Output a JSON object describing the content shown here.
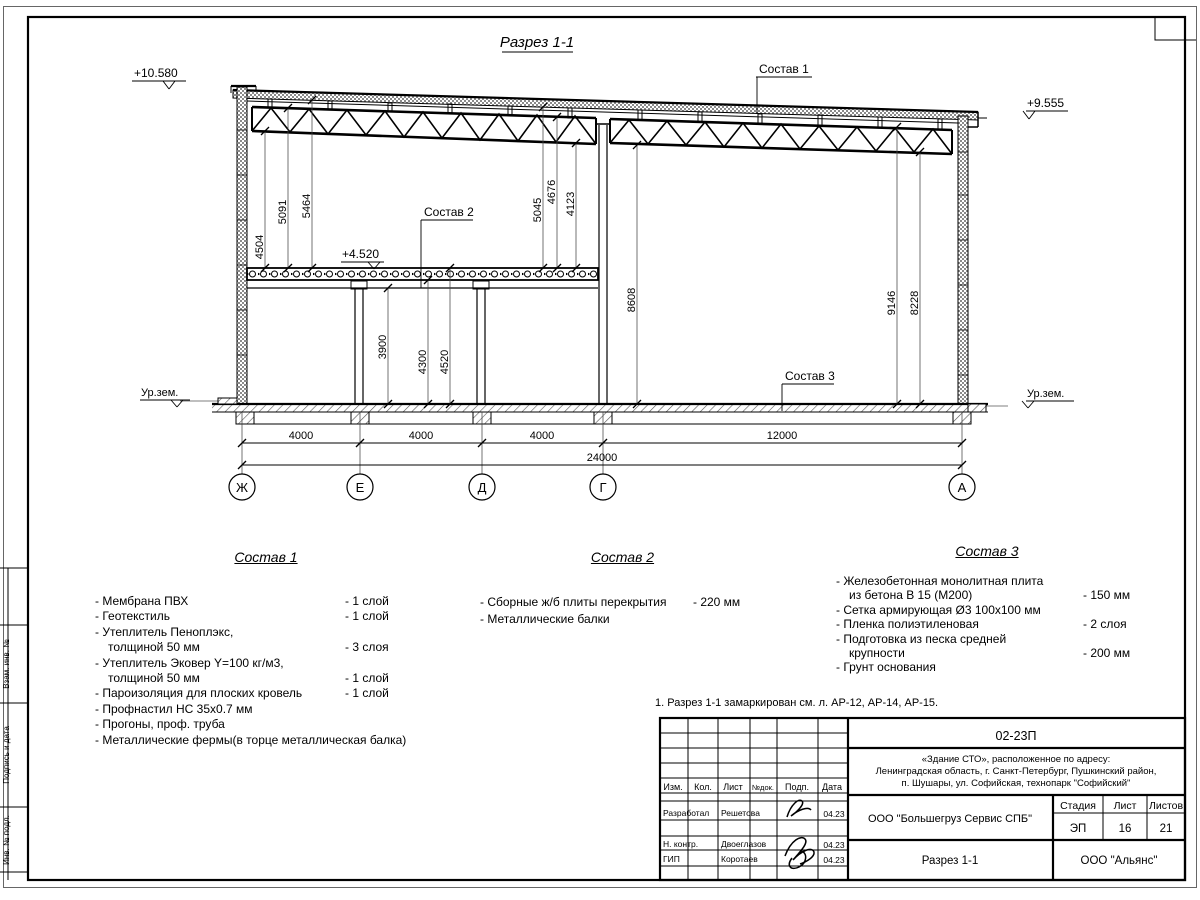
{
  "section": {
    "title": "Разрез 1-1",
    "elev_top_left": "+10.580",
    "elev_top_right": "+9.555",
    "elev_slab": "+4.520",
    "ground_left": "Ур.зем.",
    "ground_right": "Ур.зем.",
    "leader1": "Состав 1",
    "leader2": "Состав 2",
    "leader3": "Состав 3",
    "vdims": [
      "4504",
      "5091",
      "5464",
      "5045",
      "4676",
      "4123",
      "8608",
      "9146",
      "8228",
      "3900",
      "4300",
      "4520"
    ],
    "hdims": {
      "spans": [
        "4000",
        "4000",
        "4000",
        "12000"
      ],
      "total": "24000"
    },
    "axes": [
      "Ж",
      "Е",
      "Д",
      "Г",
      "А"
    ]
  },
  "compositions": [
    {
      "title": "Состав 1",
      "lines": [
        {
          "t": "- Мембрана ПВХ",
          "v": "- 1 слой"
        },
        {
          "t": "- Геотекстиль",
          "v": "- 1 слой"
        },
        {
          "t": "- Утеплитель Пеноплэкс,",
          "v": ""
        },
        {
          "t": "толщиной 50 мм",
          "v": "- 3 слоя"
        },
        {
          "t": "- Утеплитель Эковер Y=100 кг/м3,",
          "v": ""
        },
        {
          "t": "толщиной 50 мм",
          "v": "- 1 слой"
        },
        {
          "t": "- Пароизоляция для плоских кровель",
          "v": "- 1 слой"
        },
        {
          "t": "- Профнастил НС 35х0.7 мм",
          "v": ""
        },
        {
          "t": "- Прогоны, проф. труба",
          "v": ""
        },
        {
          "t": "- Металлические фермы(в торце металлическая балка)",
          "v": ""
        }
      ]
    },
    {
      "title": "Состав 2",
      "lines": [
        {
          "t": "- Сборные ж/б плиты перекрытия",
          "v": "- 220 мм"
        },
        {
          "t": "- Металлические балки",
          "v": ""
        }
      ]
    },
    {
      "title": "Состав 3",
      "lines": [
        {
          "t": "- Железобетонная  монолитная плита",
          "v": ""
        },
        {
          "t": "из бетона В 15 (М200)",
          "v": "- 150 мм"
        },
        {
          "t": "- Сетка армирующая Ø3 100х100 мм",
          "v": ""
        },
        {
          "t": "- Пленка полиэтиленовая",
          "v": "-  2 слоя"
        },
        {
          "t": "- Подготовка из песка средней",
          "v": ""
        },
        {
          "t": "крупности",
          "v": "- 200 мм"
        },
        {
          "t": "- Грунт основания",
          "v": ""
        }
      ]
    }
  ],
  "note": "1. Разрез 1-1 замаркирован см. л. АР-12, АР-14, АР-15.",
  "frame": {
    "side_labels": [
      "Взам. инв. №",
      "Подпись и дата",
      "Инв. № подл."
    ]
  },
  "titleblock": {
    "doc_number": "02-23П",
    "object_lines": [
      "«Здание СТО», расположенное по адресу:",
      "Ленинградская область, г. Санкт-Петербург, Пушкинский район,",
      "п. Шушары, ул. Софийская, технопарк \"Софийский\""
    ],
    "cols": {
      "izm": "Изм.",
      "kol": "Кол.",
      "list": "Лист",
      "ndok": "№док.",
      "podp": "Подп.",
      "data": "Дата"
    },
    "rows": [
      {
        "role": "Разработал",
        "name": "Решетова",
        "date": "04.23"
      },
      {
        "role": "Н. контр.",
        "name": "Двоеглазов",
        "date": "04.23"
      },
      {
        "role": "ГИП",
        "name": "Коротаев",
        "date": "04.23"
      }
    ],
    "company": "ООО \"Большегруз Сервис СПБ\"",
    "stage_label": "Стадия",
    "sheet_label": "Лист",
    "sheets_label": "Листов",
    "stage": "ЭП",
    "sheet": "16",
    "sheets": "21",
    "sheet_title": "Разрез 1-1",
    "org": "ООО \"Альянс\""
  }
}
